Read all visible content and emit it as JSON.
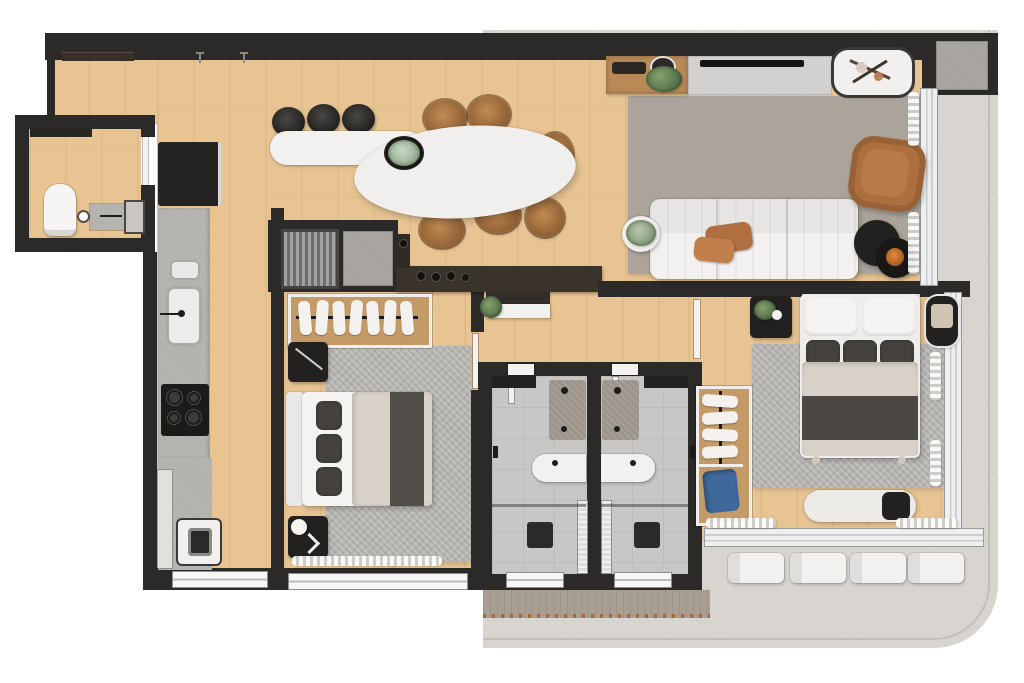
{
  "meta": {
    "title": "Apartment floor plan — photoreal top-down 3D render",
    "canvas": "1024x683",
    "notes": "No text labels are visible in the render; all content is graphical."
  },
  "palette": {
    "wall": "#2b2a28",
    "wood": "#e8c493",
    "woodDark": "#b98a58",
    "terrace": "#d7d4cf",
    "terraceLine": "#c2bfba",
    "deck": "#a99e92",
    "deckTrim": "#a4693d",
    "tile": "#c9c7c5",
    "concrete": "#b3b1ae",
    "rugGray": "#b5b3af",
    "rugWarm": "#aba49b",
    "white": "#f2f1ef",
    "beige": "#d8d2c9",
    "darkTextile": "#45423e",
    "charcoal": "#23211f",
    "tan": "#ad6f3e",
    "green": "#5f7d52",
    "blue": "#3f689b",
    "orange": "#c06a2a",
    "glass": "#eef0f0"
  },
  "rooms": [
    {
      "name": "Entry & Dining",
      "furniture": [
        "entry wall shelf",
        "white bar counter",
        "3 black bar stools",
        "oval white dining table",
        "6 tan wood chairs",
        "plant centerpiece"
      ]
    },
    {
      "name": "Kitchen & Laundry",
      "furniture": [
        "refrigerator",
        "concrete counter with double sink",
        "4-burner cooktop",
        "washing machine",
        "tall cabinet",
        "service window"
      ]
    },
    {
      "name": "Powder Room",
      "furniture": [
        "toilet",
        "concrete vanity with faucet",
        "wall niche",
        "entry door"
      ]
    },
    {
      "name": "Living Room",
      "furniture": [
        "wood TV console with potted plant",
        "wall TV",
        "white decor table",
        "area rug",
        "white 3-seat sofa",
        "tan leather pillows",
        "round side table with plant",
        "tan leather armchair",
        "black nesting coffee tables",
        "orange bowl",
        "curtains",
        "balcony glass doors"
      ]
    },
    {
      "name": "Bedroom 1",
      "furniture": [
        "open closet with 7 hanging garments",
        "desk with plant",
        "double bed with 3 dark pillows",
        "2 dark nightstands",
        "sphere lamp",
        "area rug",
        "window curtain"
      ]
    },
    {
      "name": "Bathroom 1",
      "furniture": [
        "concrete shower pad",
        "white vanity",
        "glass partition",
        "dark floor drain",
        "frosted window"
      ]
    },
    {
      "name": "Bathroom 2",
      "furniture": [
        "concrete shower pad",
        "white vanity",
        "glass partition",
        "dark floor drain",
        "frosted window"
      ]
    },
    {
      "name": "Master Bedroom",
      "furniture": [
        "open wardrobe with 4 garments",
        "blue storage piece",
        "double bed with 3 dark cushions",
        "nightstand with plant",
        "rounded nightstand with decor",
        "area rug",
        "white foot bench with dark cushion",
        "sliding glass door",
        "curtains"
      ]
    },
    {
      "name": "Utility Niche",
      "furniture": [
        "louvered laundry/AC unit",
        "gray floor mat",
        "dark bar shelf with bottles"
      ]
    },
    {
      "name": "Corridor",
      "furniture": [
        "console desk with plant",
        "bathroom doors"
      ]
    },
    {
      "name": "Side Balcony",
      "furniture": [
        "sliding glass doors"
      ]
    },
    {
      "name": "Terrace",
      "furniture": [
        "4 white loungers",
        "wood deck strip",
        "AC condenser mat in dark corner box"
      ]
    }
  ]
}
